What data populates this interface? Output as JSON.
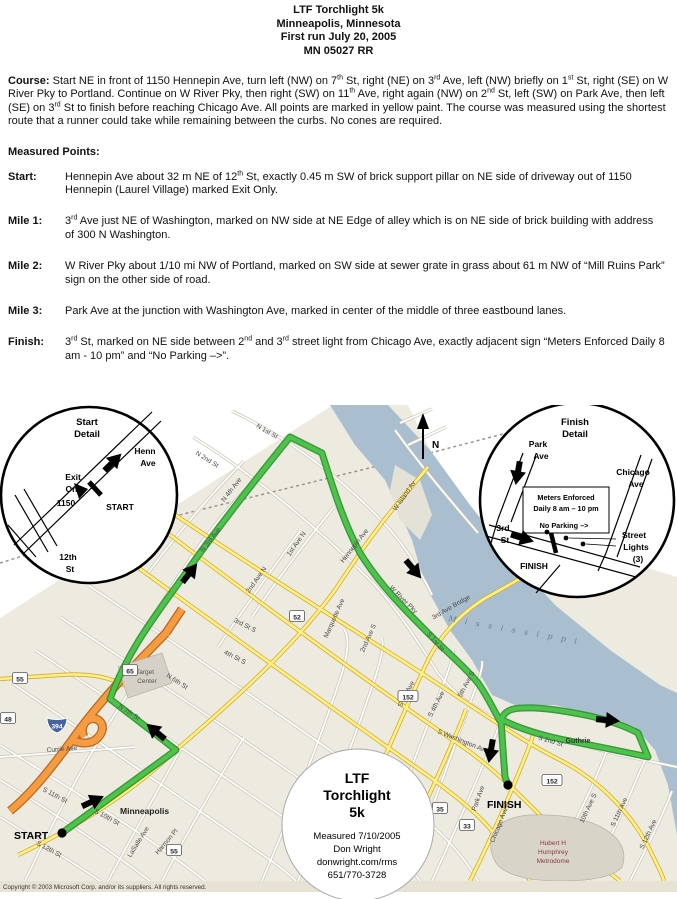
{
  "header": {
    "title": "LTF Torchlight 5k",
    "city": "Minneapolis, Minnesota",
    "first_run": "First run July 20, 2005",
    "cert": "MN 05027 RR"
  },
  "course": {
    "label": "Course:",
    "text": "Start NE in front of 1150 Hennepin Ave, turn left (NW) on 7th St, right (NE) on 3rd Ave, left (NW) briefly on 1st St, right (SE) on W River Pky to Portland.  Continue on W River Pky, then right (SW) on 11th Ave, right again (NW) on 2nd St, left (SW) on Park Ave, then left (SE) on 3rd St to finish before reaching Chicago Ave.  All points are marked in yellow paint.  The course was measured using the shortest route that a runner could take while remaining between the curbs.  No cones are required."
  },
  "measured_points": {
    "heading": "Measured Points:",
    "points": [
      {
        "label": "Start:",
        "text": "Hennepin Ave about 32 m NE of 12th St, exactly 0.45 m SW of brick support pillar on NE side of driveway out of 1150 Hennepin (Laurel Village) marked Exit Only."
      },
      {
        "label": "Mile 1:",
        "text": "3rd Ave just NE of Washington, marked on NW side at NE Edge of alley which is on NE side of brick building with address of 300 N Washington."
      },
      {
        "label": "Mile 2:",
        "text": "W River Pky about 1/10 mi NW of Portland, marked on SW side at sewer grate in grass about 61 m NW of “Mill Ruins Park” sign on the other side of road."
      },
      {
        "label": "Mile 3:",
        "text": "Park Ave at the junction with Washington Ave, marked in center of the middle of three eastbound lanes."
      },
      {
        "label": "Finish:",
        "text": "3rd St, marked on NE side between 2nd and 3rd street light from Chicago Ave, exactly adjacent sign “Meters Enforced Daily 8 am - 10 pm” and “No Parking –>”."
      }
    ]
  },
  "map": {
    "north_label": "N",
    "start_marker": "START",
    "finish_marker": "FINISH",
    "city_label": "Minneapolis",
    "river_label": "M i s s i s s i p p i",
    "guthrie_label": "Guthrie",
    "target_center": [
      "Target",
      "Center"
    ],
    "metrodome": [
      "Hubert H",
      "Humphrey",
      "Metrodome"
    ],
    "copyright": "Copyright © 2003 Microsoft Corp. and/or its suppliers. All rights reserved.",
    "bubble": {
      "title": [
        "LTF",
        "Torchlight",
        "5k"
      ],
      "info": [
        "Measured 7/10/2005",
        "Don Wright",
        "donwright.com/rms",
        "651/770-3728"
      ]
    },
    "start_detail": {
      "title": [
        "Start",
        "Detail"
      ],
      "henn": [
        "Henn",
        "Ave"
      ],
      "exit": [
        "Exit",
        "Only"
      ],
      "num": "1150",
      "start": "START",
      "twelfth": [
        "12th",
        "St"
      ]
    },
    "finish_detail": {
      "title": [
        "Finish",
        "Detail"
      ],
      "park": [
        "Park",
        "Ave"
      ],
      "chicago": [
        "Chicago",
        "Ave"
      ],
      "meters": [
        "Meters Enforced",
        "Daily 8 am – 10 pm"
      ],
      "no_parking": "No Parking –>",
      "third": [
        "3rd",
        "St"
      ],
      "finish": "FINISH",
      "lights": [
        "Street",
        "Lights",
        "(3)"
      ]
    },
    "street_labels": [
      {
        "t": "N 4th Ave",
        "x": 233,
        "y": 86,
        "r": -52
      },
      {
        "t": "N 3rd Ave",
        "x": 212,
        "y": 136,
        "r": -52
      },
      {
        "t": "2nd Ave N",
        "x": 258,
        "y": 176,
        "r": -55
      },
      {
        "t": "1st Ave N",
        "x": 298,
        "y": 140,
        "r": -55
      },
      {
        "t": "Hennepin Ave",
        "x": 356,
        "y": 142,
        "r": -52
      },
      {
        "t": "N 2nd St",
        "x": 206,
        "y": 56,
        "r": 32
      },
      {
        "t": "N 1st St",
        "x": 266,
        "y": 28,
        "r": 30
      },
      {
        "t": "W Island Av",
        "x": 406,
        "y": 92,
        "r": -55
      },
      {
        "t": "W River Pky",
        "x": 402,
        "y": 196,
        "r": 45
      },
      {
        "t": "3rd Ave Bridge",
        "x": 452,
        "y": 204,
        "r": -30
      },
      {
        "t": "S 1st St",
        "x": 434,
        "y": 238,
        "r": 50
      },
      {
        "t": "Marquette Ave",
        "x": 336,
        "y": 214,
        "r": -66
      },
      {
        "t": "2nd Ave S",
        "x": 370,
        "y": 234,
        "r": -66
      },
      {
        "t": "3rd St S",
        "x": 244,
        "y": 222,
        "r": 27
      },
      {
        "t": "4th St S",
        "x": 234,
        "y": 254,
        "r": 27
      },
      {
        "t": "S 3rd Ave",
        "x": 408,
        "y": 290,
        "r": -62
      },
      {
        "t": "S 4th Ave",
        "x": 438,
        "y": 300,
        "r": -62
      },
      {
        "t": "5th Ave S",
        "x": 468,
        "y": 280,
        "r": -62
      },
      {
        "t": "S Washington Ave",
        "x": 462,
        "y": 338,
        "r": 22
      },
      {
        "t": "S 2nd St",
        "x": 550,
        "y": 338,
        "r": 16
      },
      {
        "t": "Portland Ave S",
        "x": 416,
        "y": 430,
        "r": -62
      },
      {
        "t": "Park Ave",
        "x": 480,
        "y": 394,
        "r": -70
      },
      {
        "t": "Chicago Ave S",
        "x": 502,
        "y": 418,
        "r": -68
      },
      {
        "t": "10th Ave S",
        "x": 590,
        "y": 404,
        "r": -65
      },
      {
        "t": "S 11th Ave",
        "x": 621,
        "y": 408,
        "r": -65
      },
      {
        "t": "S 12th Ave",
        "x": 650,
        "y": 430,
        "r": -65
      },
      {
        "t": "Currie Ave",
        "x": 62,
        "y": 346,
        "r": -4
      },
      {
        "t": "N 7th St",
        "x": 128,
        "y": 309,
        "r": 33
      },
      {
        "t": "N 6th St",
        "x": 176,
        "y": 278,
        "r": 33
      },
      {
        "t": "S 10th St",
        "x": 106,
        "y": 414,
        "r": 28
      },
      {
        "t": "S 11th St",
        "x": 54,
        "y": 392,
        "r": 28
      },
      {
        "t": "S 12th St",
        "x": 48,
        "y": 446,
        "r": 28
      },
      {
        "t": "LaSalle Ave",
        "x": 140,
        "y": 438,
        "r": -58
      },
      {
        "t": "Harmon Pl",
        "x": 168,
        "y": 438,
        "r": -50
      }
    ],
    "shields": [
      {
        "n": "394",
        "x": 57,
        "y": 320,
        "i": true
      },
      {
        "n": "52",
        "x": 297,
        "y": 212
      },
      {
        "n": "152",
        "x": 408,
        "y": 292
      },
      {
        "n": "152",
        "x": 552,
        "y": 376
      },
      {
        "n": "55",
        "x": 174,
        "y": 446
      },
      {
        "n": "55",
        "x": 20,
        "y": 274
      },
      {
        "n": "65",
        "x": 130,
        "y": 266
      },
      {
        "n": "35",
        "x": 440,
        "y": 404
      },
      {
        "n": "33",
        "x": 467,
        "y": 421
      },
      {
        "n": "48",
        "x": 8,
        "y": 314
      }
    ],
    "arrows": [
      {
        "x": 102,
        "y": 392,
        "a": -25
      },
      {
        "x": 148,
        "y": 320,
        "a": -140
      },
      {
        "x": 196,
        "y": 160,
        "a": -52
      },
      {
        "x": 420,
        "y": 172,
        "a": 50
      },
      {
        "x": 618,
        "y": 316,
        "a": 5
      },
      {
        "x": 489,
        "y": 356,
        "a": 100
      },
      {
        "x": 120,
        "y": 50,
        "a": -45
      },
      {
        "x": 516,
        "y": 78,
        "a": 100
      },
      {
        "x": 532,
        "y": 136,
        "a": 17
      }
    ],
    "colors": {
      "route_green": "#4cc44c",
      "route_edge": "#2a8f2a",
      "map_beige": "#edeae0",
      "river_blue": "#a9bfd0",
      "road_yellow": "#fff282",
      "highway_orange": "#f59b42"
    }
  }
}
